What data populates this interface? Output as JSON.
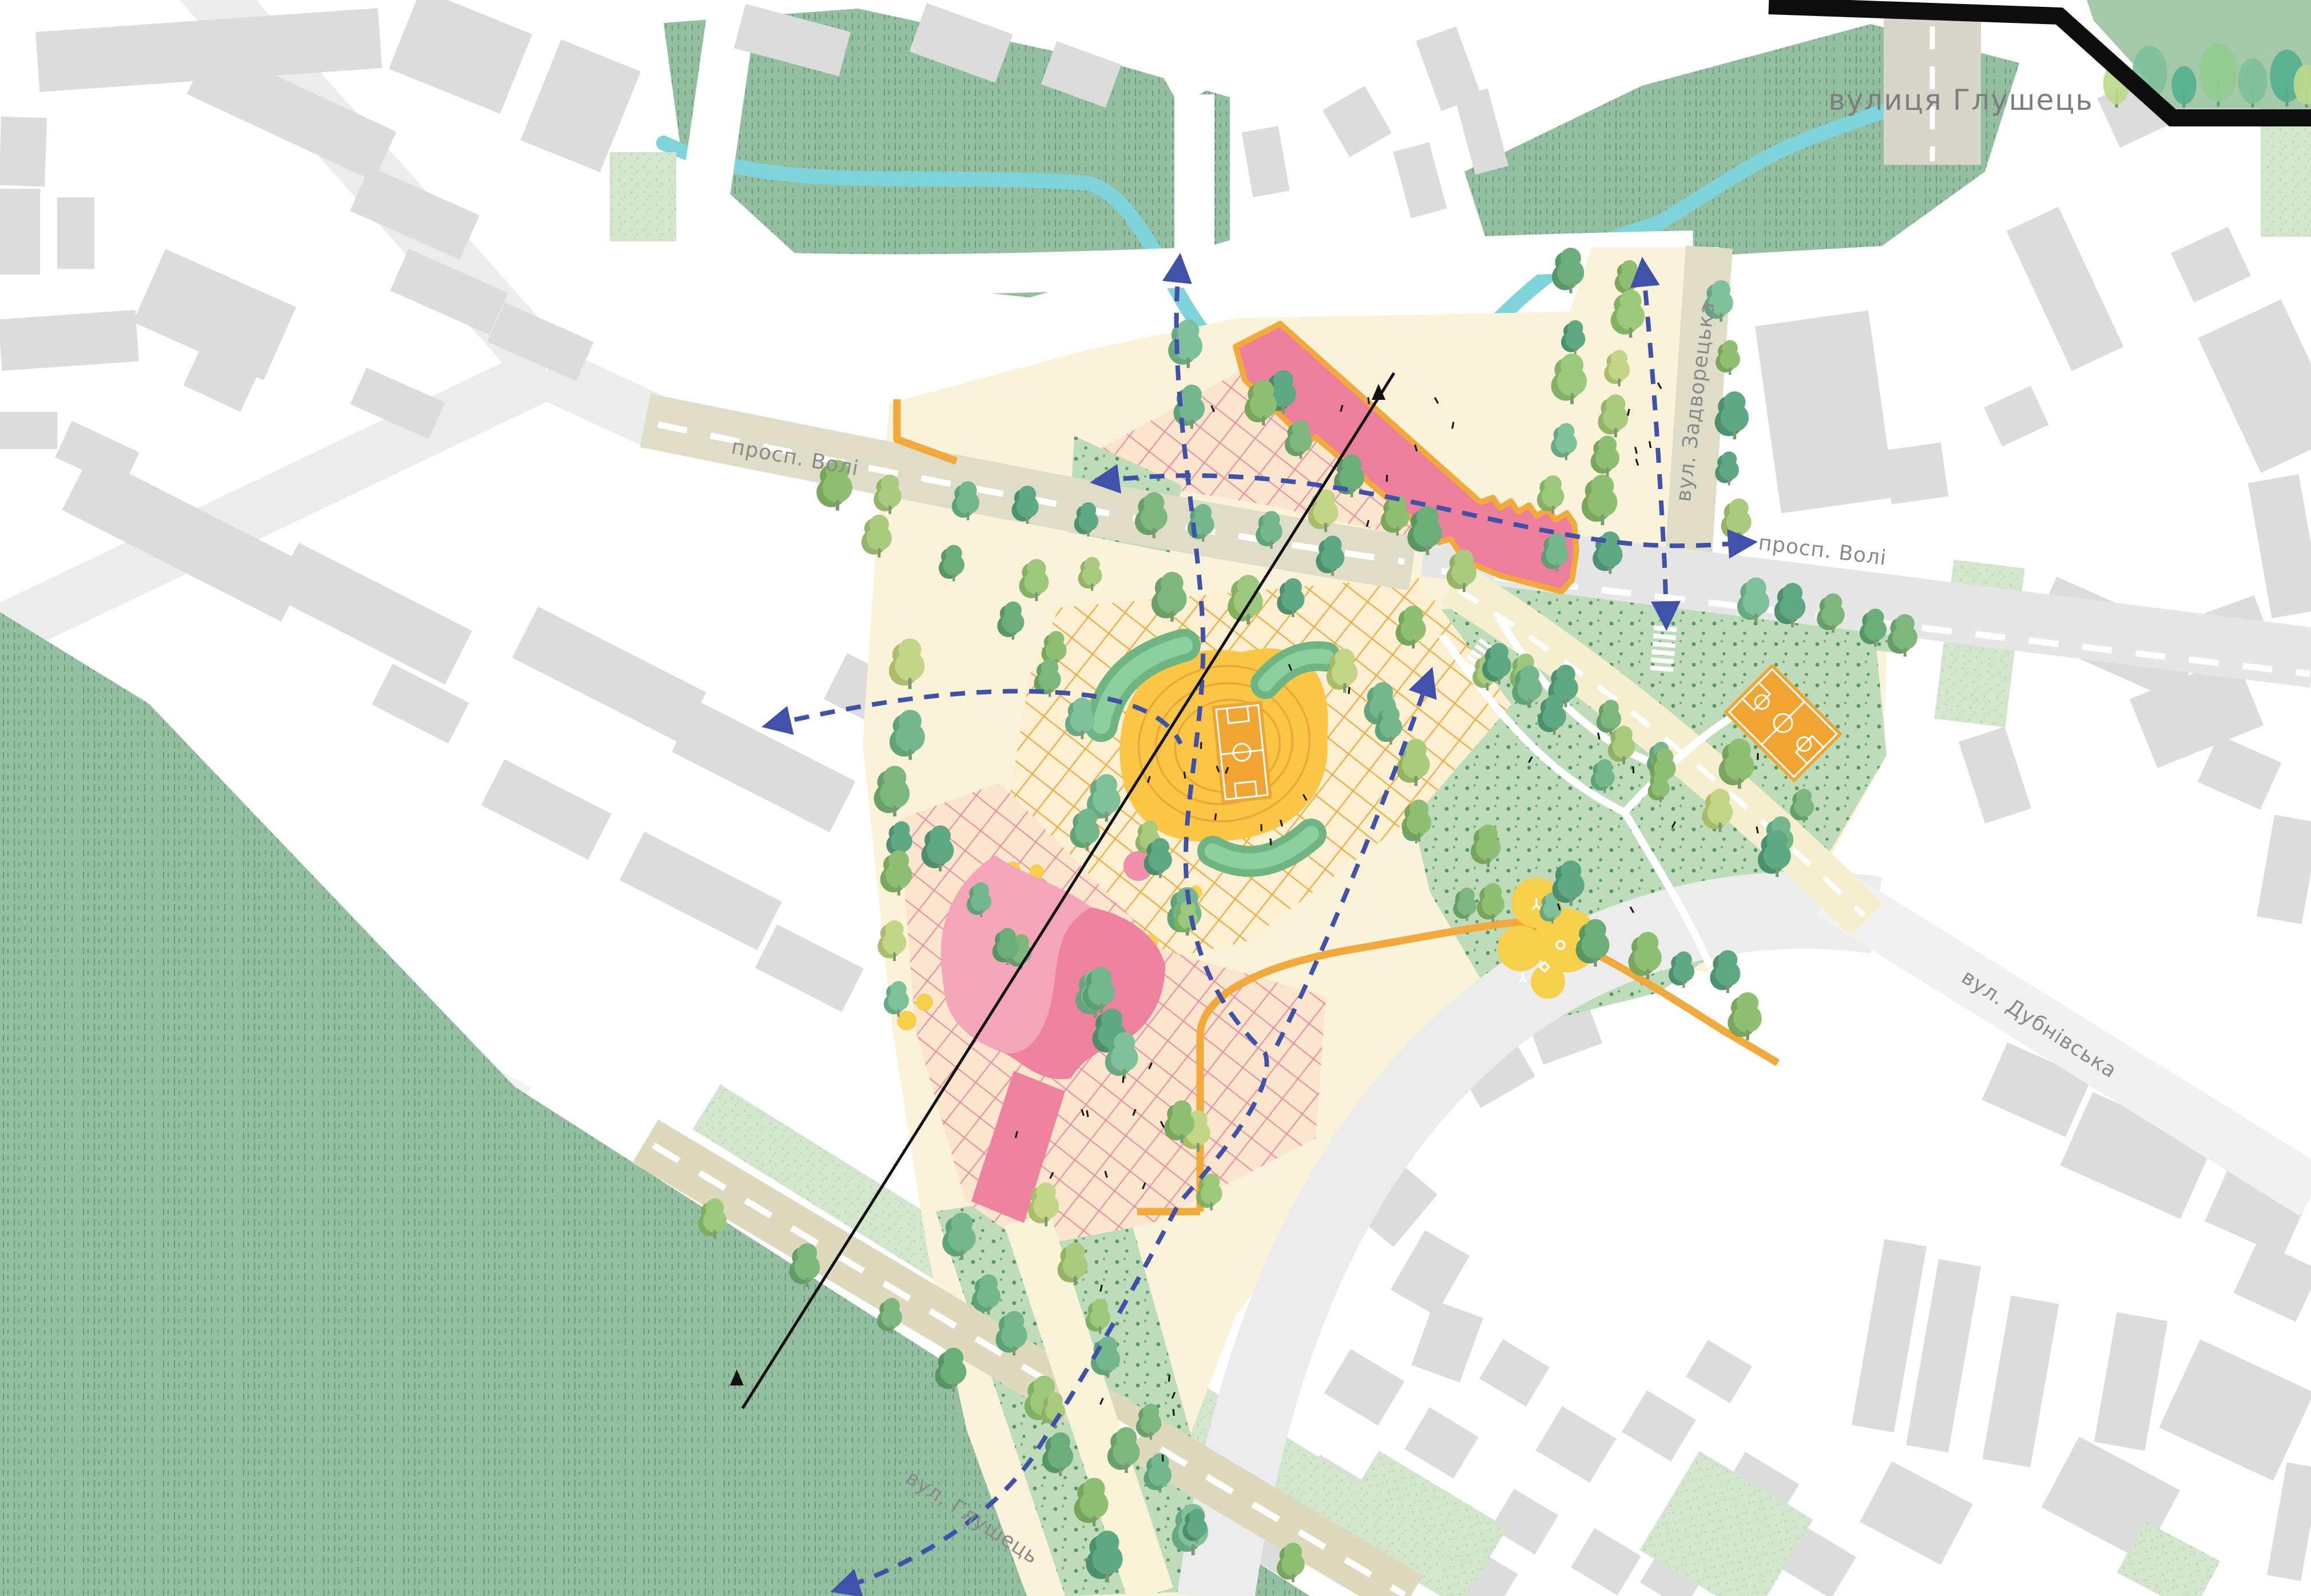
{
  "map": {
    "street_labels": [
      {
        "id": "vulytsia-hlushets-top",
        "text": "вулиця Глушець"
      },
      {
        "id": "prosp-voli-west",
        "text": "просп. Волі"
      },
      {
        "id": "vul-zadvoretska",
        "text": "вул. Задворецька"
      },
      {
        "id": "prosp-voli-east",
        "text": "просп. Волі"
      },
      {
        "id": "vul-dubnivska",
        "text": "вул. Дубнівська"
      },
      {
        "id": "vul-hlushets-south",
        "text": "вул. Глушець"
      }
    ],
    "features": [
      "meadow",
      "stream",
      "central-lawn-bowl",
      "sports-court",
      "basketball-court",
      "children-playground",
      "community-building-existing",
      "community-building-new",
      "green-mound",
      "pedestrian-route",
      "section-line",
      "tree",
      "crosswalk",
      "plaza-paving"
    ],
    "colors": {
      "meadow": "#93bfa0",
      "lawn_dots": "#bedcba",
      "speckle": "#d3e5cd",
      "stream": "#7fd3da",
      "site_cream": "#faf3da",
      "road_beige": "#dfddc8",
      "road_grey": "#e8e8e8",
      "hatch_orange": "#f3a93c",
      "hatch_pink": "#f0879f",
      "stadium_yellow": "#fbc645",
      "court_orange": "#f0a432",
      "building_pink": "#ec7f9b",
      "context_grey": "#dcdcdc",
      "route_blue": "#3f51a8",
      "playground_yellow": "#f6cf4b",
      "label_grey": "#8a8a8a",
      "accent_orange": "#f2a93b"
    }
  }
}
